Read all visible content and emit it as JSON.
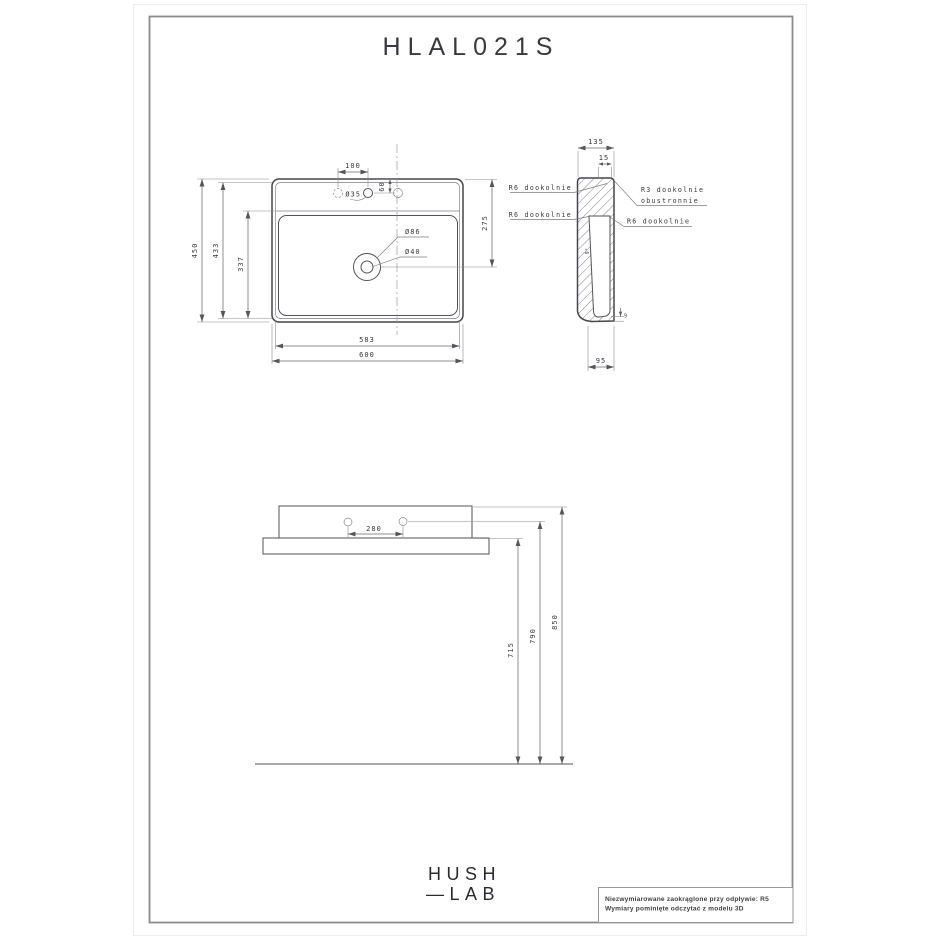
{
  "title": "HLAL021S",
  "views": {
    "plan": {
      "dim_100": "100",
      "dim_60": "60",
      "hole_dia": "Ø35",
      "drain_outer_dia": "Ø86",
      "drain_inner_dia": "Ø40",
      "dim_275": "275",
      "dim_450": "450",
      "dim_433": "433",
      "dim_337": "337",
      "dim_583": "583",
      "dim_600": "600"
    },
    "section": {
      "dim_135": "135",
      "dim_15": "15",
      "dim_95": "95",
      "wall_angle": "9°",
      "bottom_thickness": "9",
      "label_r6_top": "R6 dookolnie",
      "label_r6_mid": "R6 dookolnie",
      "label_r3_line1": "R3 dookolnie",
      "label_r3_line2": "obustronnie",
      "label_r6_right": "R6 dookolnie"
    },
    "front": {
      "dim_280": "280",
      "dim_715": "715",
      "dim_790": "790",
      "dim_850": "850"
    }
  },
  "logo": {
    "line1": "HUSH",
    "line2": "—LAB"
  },
  "notes": {
    "line1": "Niezwymiarowane zaokrąglone przy odpływie: R5",
    "line2": "Wymiary pominięte odczytać z modelu 3D"
  },
  "colors": {
    "line": "#46464b",
    "dim_line": "#6a6a6f",
    "text": "#37373b",
    "frame": "#8c8c90",
    "background": "#ffffff"
  }
}
